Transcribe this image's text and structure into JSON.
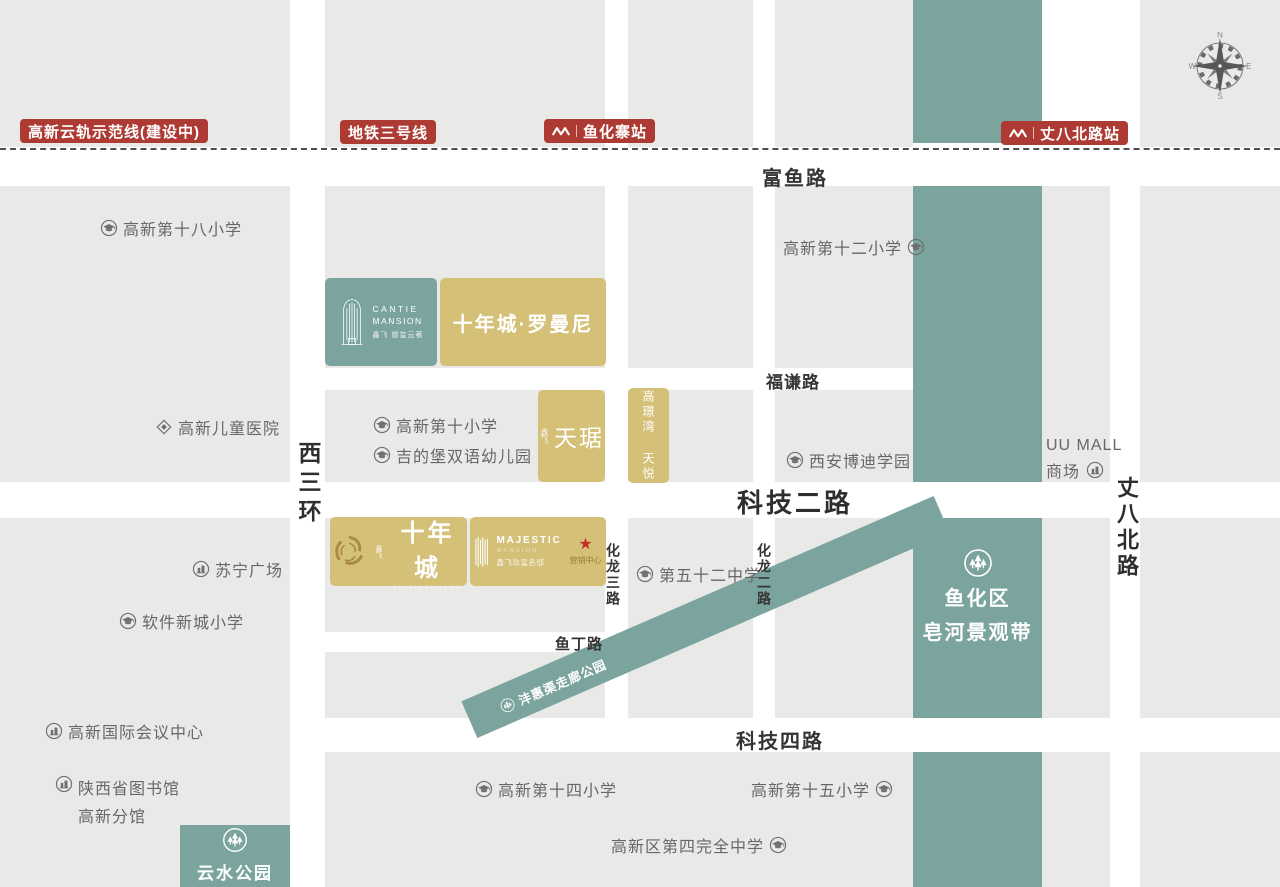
{
  "colors": {
    "teal_band": "#7BA49E",
    "gold_block": "#D5C078",
    "badge_red": "#AE3A34",
    "block_gray": "#E9E9E8",
    "road_text": "#353535",
    "landmark_text": "#676767",
    "star_red": "#C23028"
  },
  "transit": {
    "cloud_rail_badge": "高新云轨示范线(建设中)",
    "line3_badge": "地铁三号线",
    "station_yuhuazhai": "鱼化寨站",
    "station_zhangbabei": "丈八北路站"
  },
  "roads": {
    "fuyu": "富鱼路",
    "fuqian": "福谦路",
    "keji2": "科技二路",
    "yuding": "鱼丁路",
    "keji4": "科技四路",
    "xisanhuan": "西三环",
    "hualong3": "化龙三路",
    "hualong2": "化龙二路",
    "zhangbabei": "丈八北路"
  },
  "landmarks": {
    "gaoxin18": "高新第十八小学",
    "ertong_hospital": "高新儿童医院",
    "gaoxin10": "高新第十小学",
    "jidibao": "吉的堡双语幼儿园",
    "gaoxin12": "高新第十二小学",
    "bodi": "西安博迪学园",
    "uu_mall_line1": "UU MALL",
    "uu_mall_line2": "商场",
    "suning": "苏宁广场",
    "ruanjian": "软件新城小学",
    "no52": "第五十二中学",
    "conference": "高新国际会议中心",
    "library_line1": "陕西省图书馆",
    "library_line2": "高新分馆",
    "gaoxin14": "高新第十四小学",
    "gaoxin15": "高新第十五小学",
    "no4_middle": "高新区第四完全中学"
  },
  "parks": {
    "belt_line1": "鱼化区",
    "belt_line2": "皂河景观带",
    "fenghui": "沣惠渠走廊公园",
    "yunshui": "云水公园"
  },
  "projects": {
    "cantie_en1": "CANTIE",
    "cantie_en2": "MANSION",
    "cantie_cn": "鑫飞 御玺云著",
    "romanni": "十年城·罗曼尼",
    "tianju_prefix": "鑫飞",
    "tianju": "天琚",
    "tianyue": "高璟湾 天悦",
    "snc_prefix": "鑫飞",
    "snc": "十年城",
    "snc_sub": "SHINIANCHENG",
    "majestic_en": "MAJESTIC",
    "majestic_sub": "MANSION",
    "majestic_cn": "鑫飞玖玺名邸",
    "sales_center": "营销中心"
  },
  "compass": {
    "n": "N",
    "e": "E",
    "s": "S",
    "w": "W"
  }
}
